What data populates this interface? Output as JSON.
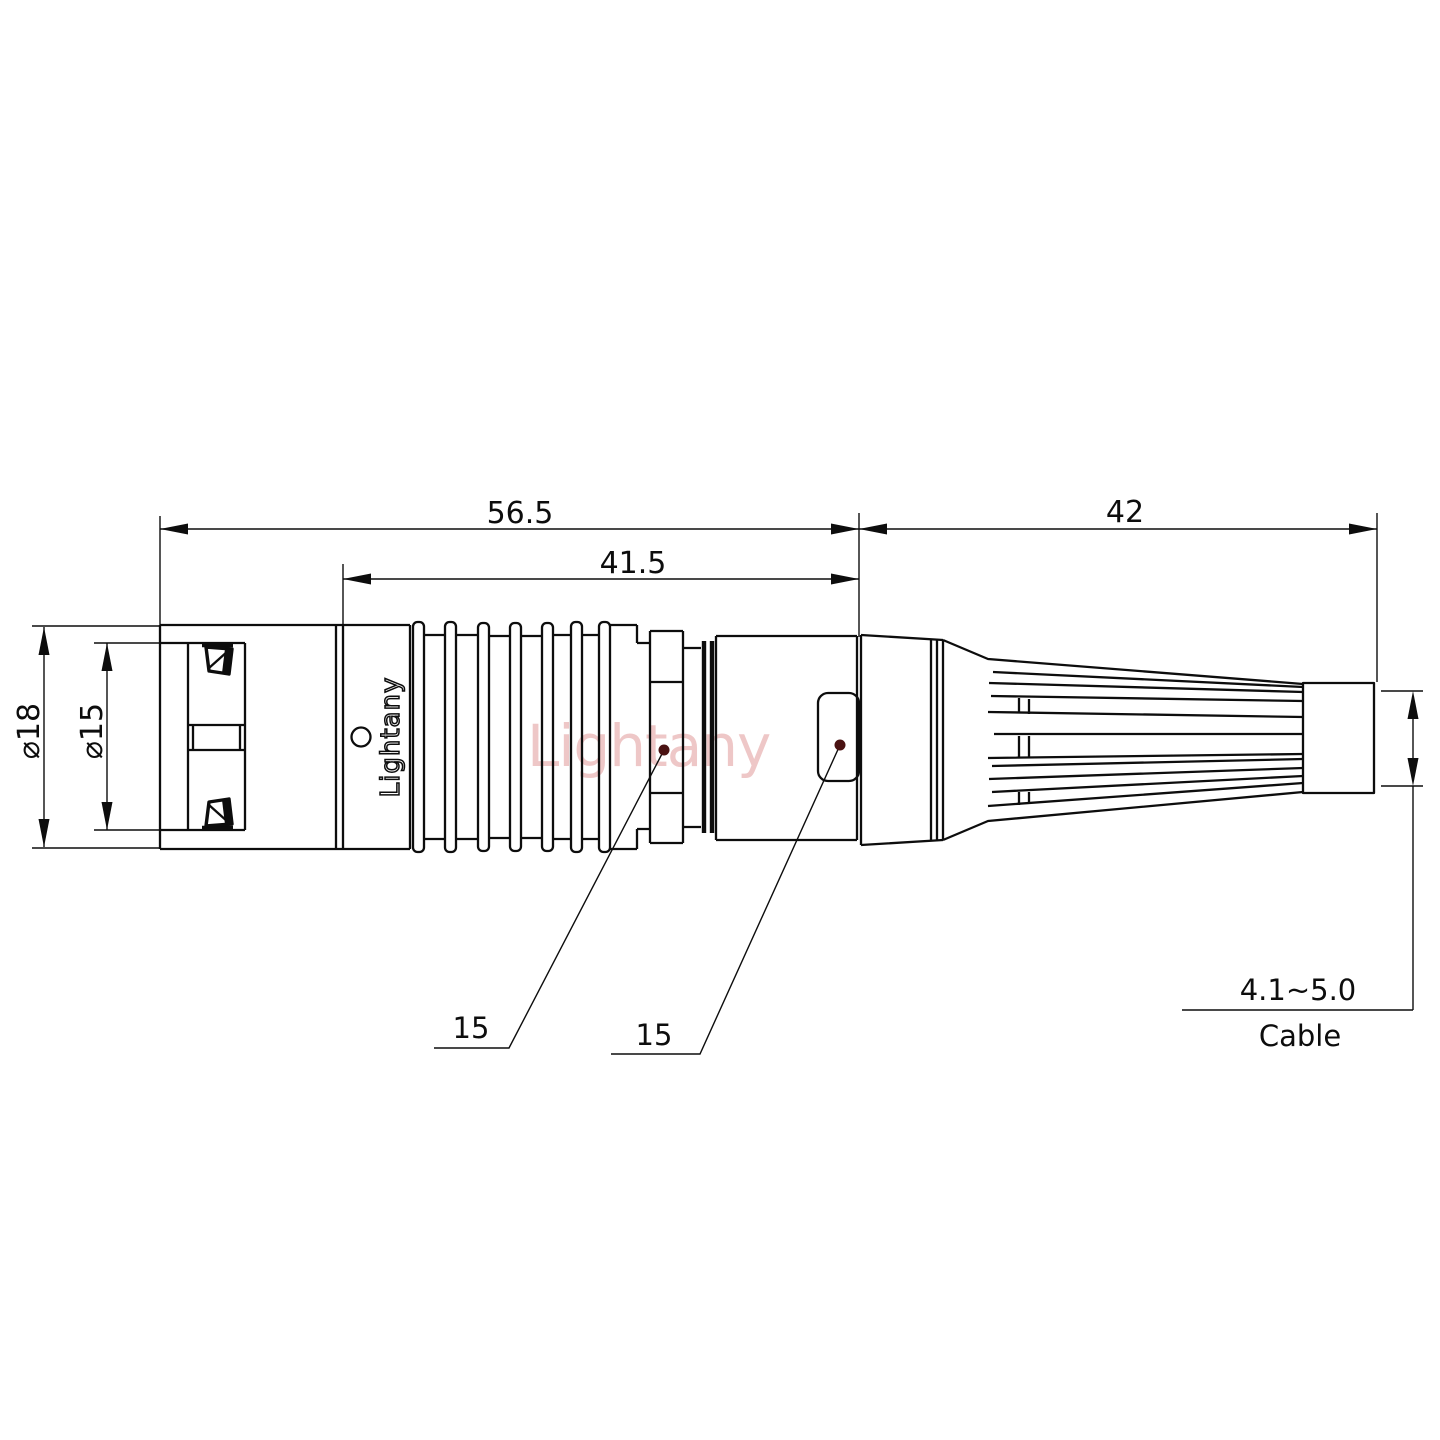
{
  "page": {
    "background": "#ffffff"
  },
  "drawing": {
    "type": "technical-drawing",
    "subject": "circular push-pull connector plug with cable bend-relief boot, side view",
    "colors": {
      "line": "#0d0d0d",
      "watermark_red": "#d97b7b",
      "leader_dot": "#4a1212"
    },
    "dimensions": {
      "overall_length": "56.5",
      "grip_length": "41.5",
      "boot_length": "42",
      "outer_diameter": "⌀18",
      "front_diameter": "⌀15",
      "nut_callout": "15",
      "backshell_callout": "15",
      "cable_diameter_range": "4.1~5.0",
      "cable_label": "Cable"
    },
    "branding": {
      "body_logo": "Lightany",
      "watermark": "Lightany"
    }
  }
}
